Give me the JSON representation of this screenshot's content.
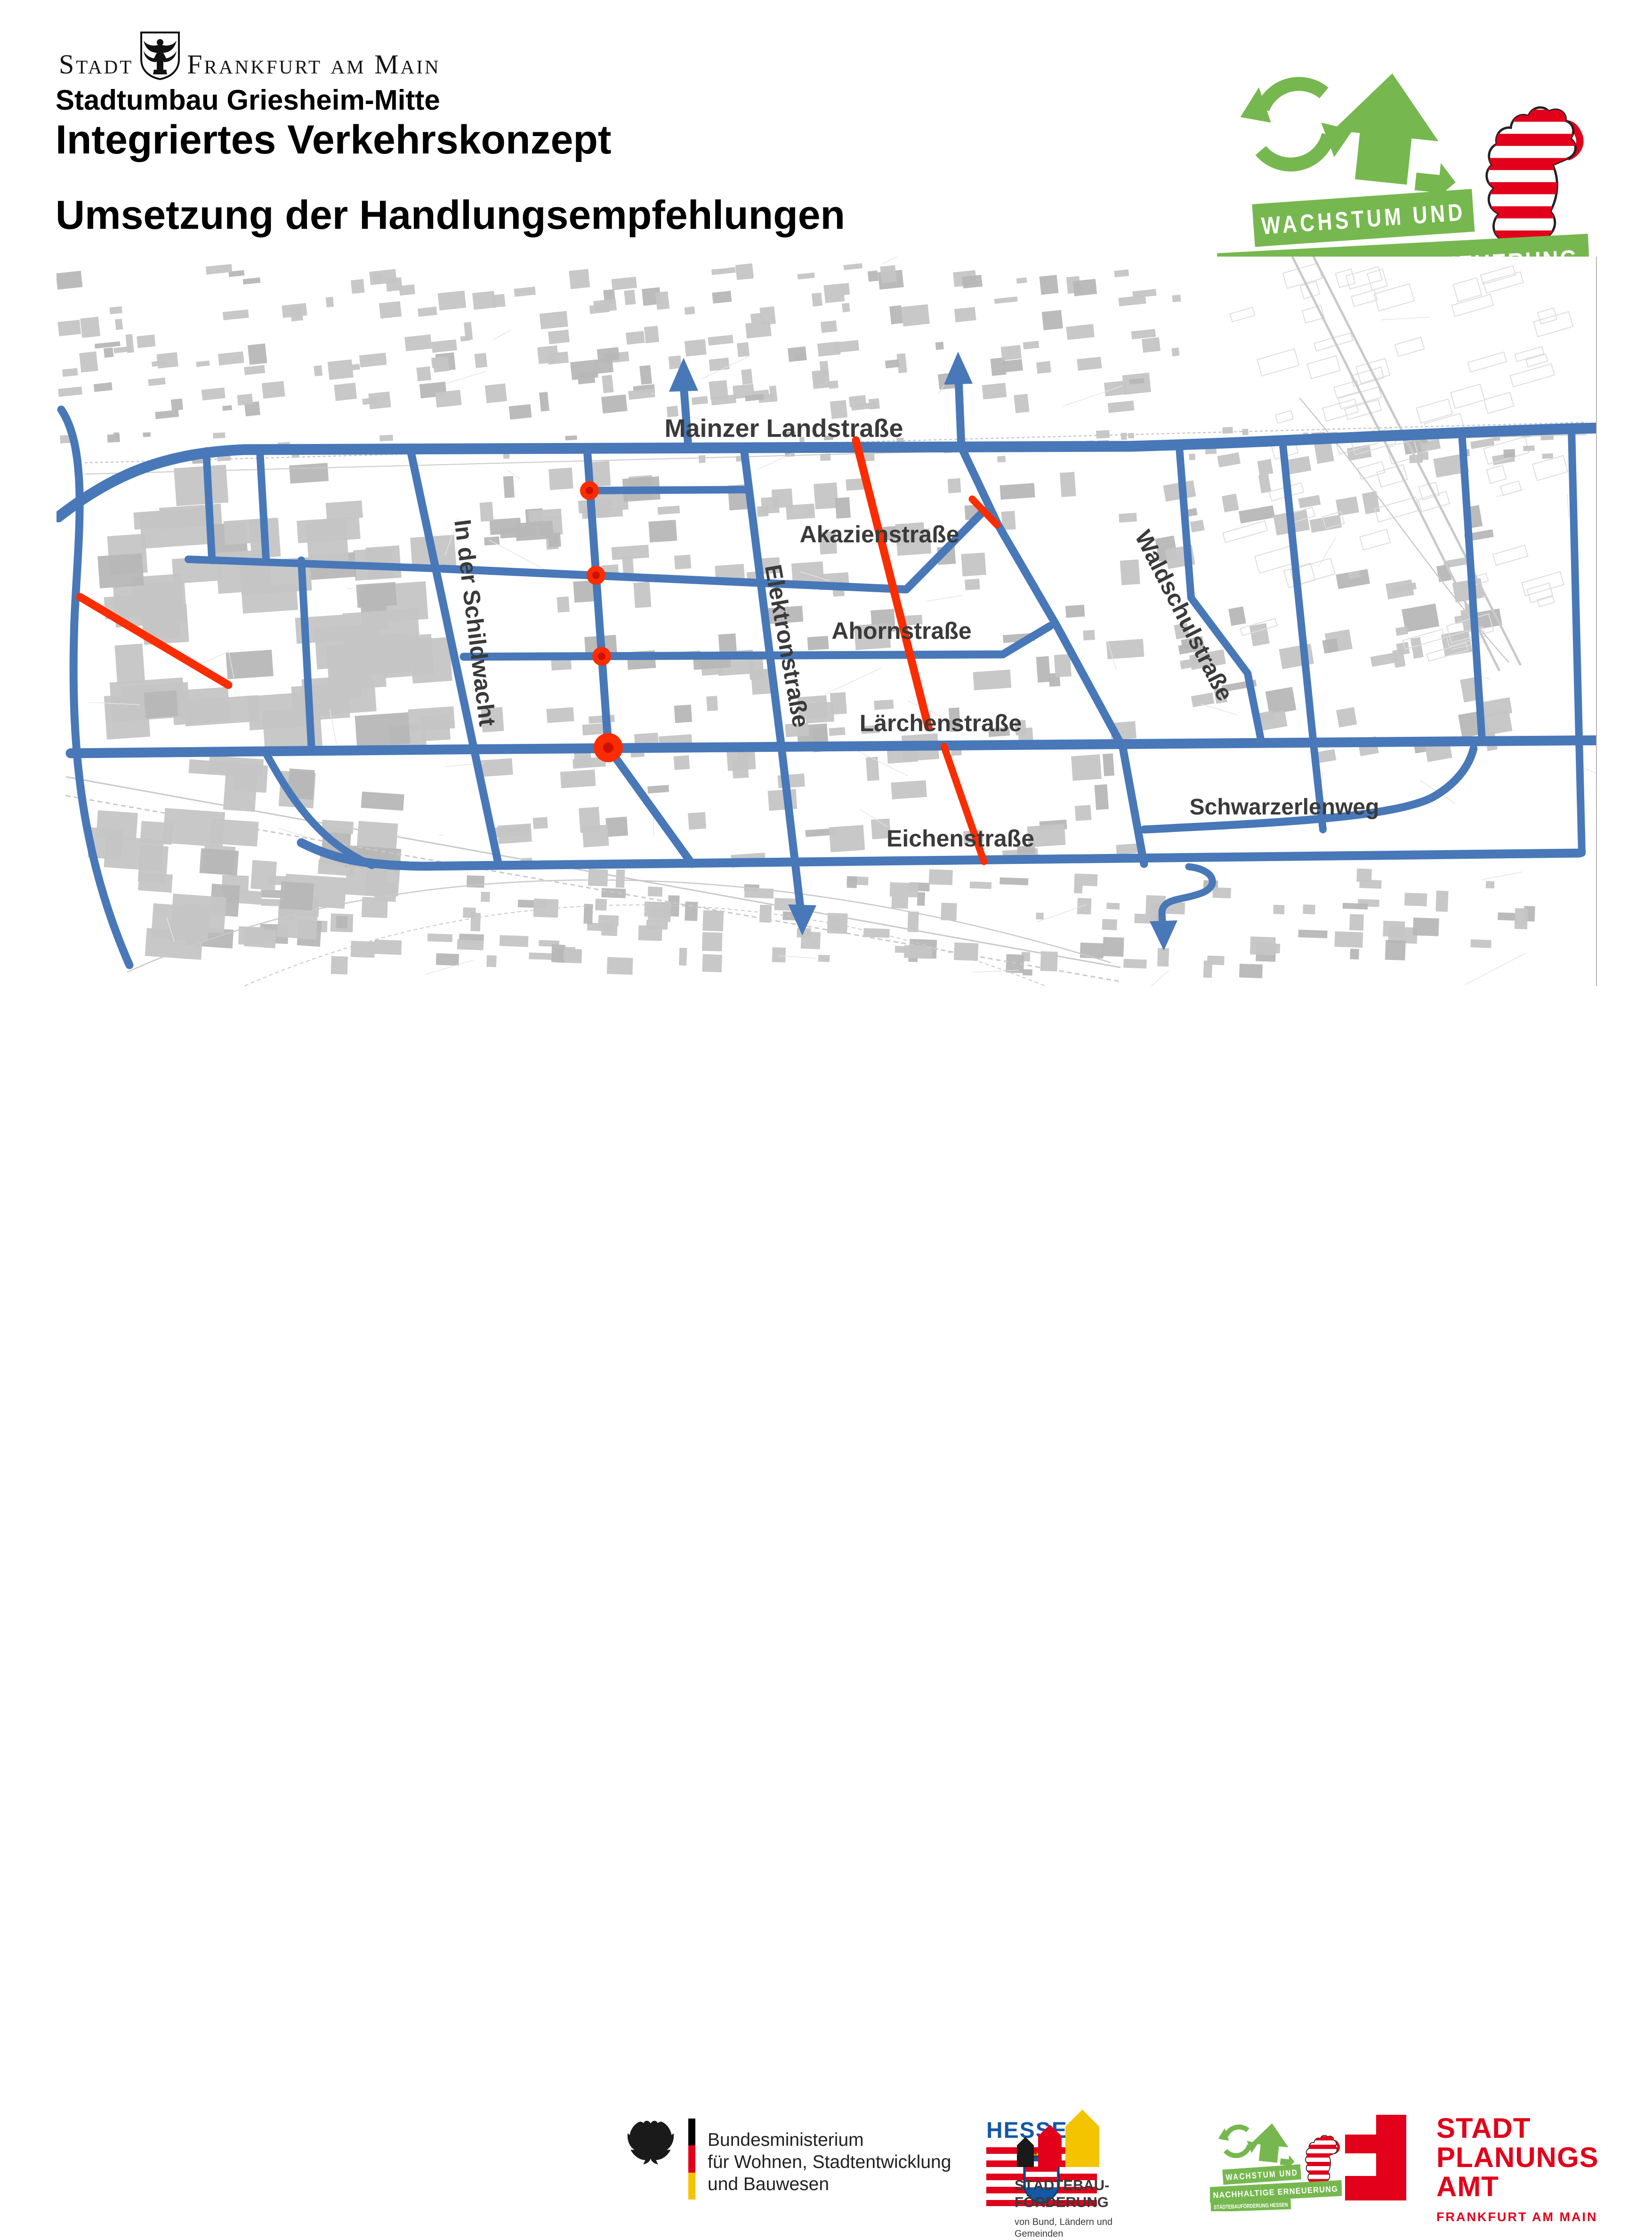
{
  "header": {
    "city_logo": {
      "stadt": "Stadt",
      "rest": "Frankfurt am Main"
    },
    "subtitle": "Stadtumbau Griesheim-Mitte",
    "title": "Integriertes Verkehrskonzept",
    "title2": "Umsetzung der Handlungsempfehlungen"
  },
  "program_logo": {
    "line1": "WACHSTUM UND",
    "line2": "NACHHALTIGE ERNEUERUNG",
    "line3": "STÄDTEBAUFÖRDERUNG HESSEN",
    "green": "#76b84f"
  },
  "map": {
    "colors": {
      "network_blue": "#4878b8",
      "measure_red": "#fa2d00",
      "building_gray": "#c5c5c5"
    },
    "street_labels": [
      {
        "name": "Mainzer Landstraße"
      },
      {
        "name": "Akazienstraße"
      },
      {
        "name": "Ahornstraße"
      },
      {
        "name": "Lärchenstraße"
      },
      {
        "name": "Eichenstraße"
      },
      {
        "name": "Schwarzerlenweg"
      },
      {
        "name": "In der Schildwacht"
      },
      {
        "name": "Elektronstraße"
      },
      {
        "name": "Waldschulstraße"
      }
    ],
    "marker_dot_count": 4,
    "arrow_count": 4
  },
  "footer": {
    "bmwsb": {
      "line1": "Bundesministerium",
      "line2": "für Wohnen, Stadtentwicklung",
      "line3": "und Bauwesen"
    },
    "hessen": {
      "title": "HESSEN"
    },
    "staedtebau": {
      "line1": "STÄDTEBAU-",
      "line2": "FÖRDERUNG",
      "sub1": "von Bund, Ländern und",
      "sub2": "Gemeinden"
    },
    "spa": {
      "line1": "STADT",
      "line2": "PLANUNGS",
      "line3": "AMT",
      "sub": "FRANKFURT AM MAIN"
    }
  }
}
